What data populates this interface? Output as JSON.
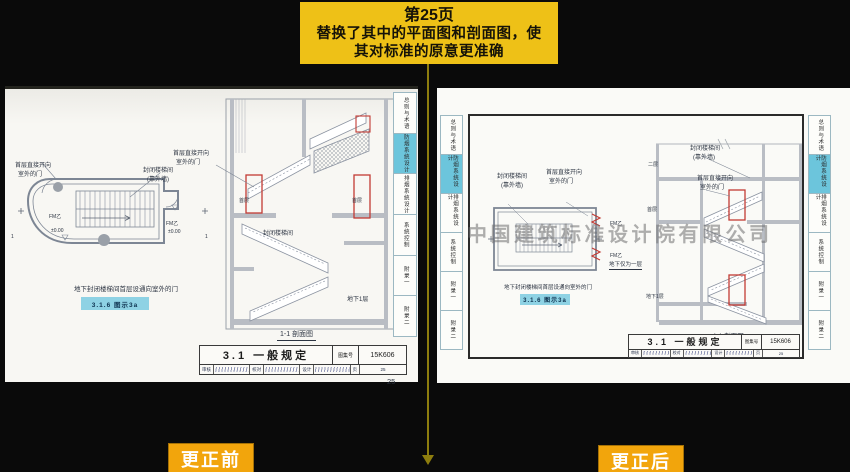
{
  "banner": {
    "page_line": "第25页",
    "line2": "替换了其中的平面图和剖面图，使",
    "line3": "其对标准的原意更准确"
  },
  "footer": {
    "before_label": "更正前",
    "after_label": "更正后"
  },
  "sidebar_tabs": [
    "总则与术语",
    "防烟系统设计",
    "排烟系统设计",
    "系统控制",
    "附录一",
    "附录二"
  ],
  "watermark": "中国建筑标准设计院有限公司",
  "drawing_labels": {
    "door_callout_line1": "首层直接开向",
    "door_callout_line2": "室外的门",
    "stair_callout_line1": "封闭楼梯间",
    "stair_callout_line2": "(靠外墙)",
    "enclosed_stair": "封闭楼梯间",
    "door_tag": "FM乙",
    "level_zero": "±0.00",
    "second_floor": "二层",
    "first_floor": "首层",
    "basement_level": "地下1层",
    "basement_only_note": "地下仅为一层",
    "section_mark": "1",
    "plan_caption": "地下封闭楼梯间首层设通向室外的门",
    "figure_ref": "3.1.6 图示3a",
    "section_caption": "1-1 剖面图"
  },
  "titleblock": {
    "title": "3.1 一般规定",
    "fig_no_label": "图集号",
    "fig_no": "15K606",
    "review_label": "审核",
    "check_label": "校对",
    "design_label": "设计",
    "page_label": "页",
    "page_number": "25"
  },
  "corner_page_number": "25",
  "colors": {
    "banner_yellow": "#eec117",
    "tag_orange": "#f2a50c",
    "tab_highlight": "#6cc5dc",
    "door_red": "#c23b34",
    "figref_cyan": "#8ed2e4"
  }
}
